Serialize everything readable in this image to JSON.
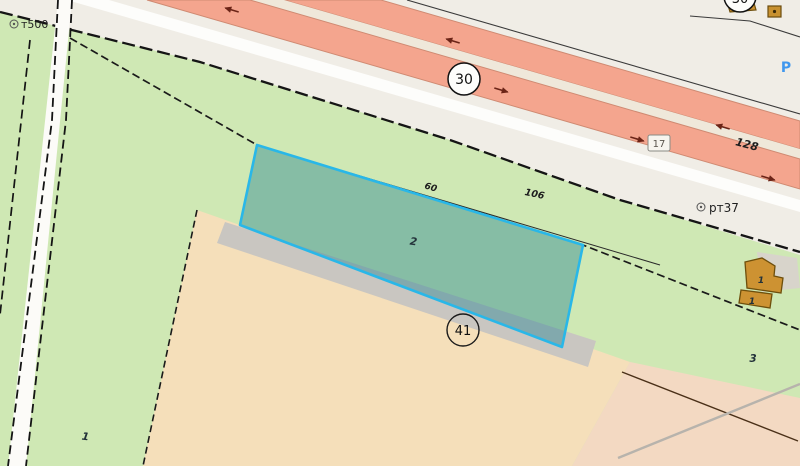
{
  "map": {
    "survey_point_left": "т500",
    "survey_point_right": "рт37",
    "road_number_main": "30",
    "road_number_top_right": "30",
    "road_number_junction": "41",
    "road_segment_box": "17",
    "distance_128": "128",
    "distance_106": "106",
    "distance_60": "60",
    "selected_parcel_number": "2",
    "parcel_left_number": "1",
    "parcel_right_number": "3",
    "building_number_upper": "1",
    "building_number_lower": "1",
    "parking_symbol": "P",
    "colors": {
      "selection_stroke": "#29b7e8",
      "selection_fill": "rgba(26,125,142,0.40)",
      "highway_lane_salmon": "#f4a58e",
      "greenery": "#cfe8b4",
      "parcel_beige": "#f5dfba",
      "road_pink": "#f3d9c2",
      "road_white": "#f0ede6",
      "gray_strip": "#c9c6c1",
      "building_ochre": "#cd9232",
      "parking_blue": "#3f97ee"
    }
  }
}
